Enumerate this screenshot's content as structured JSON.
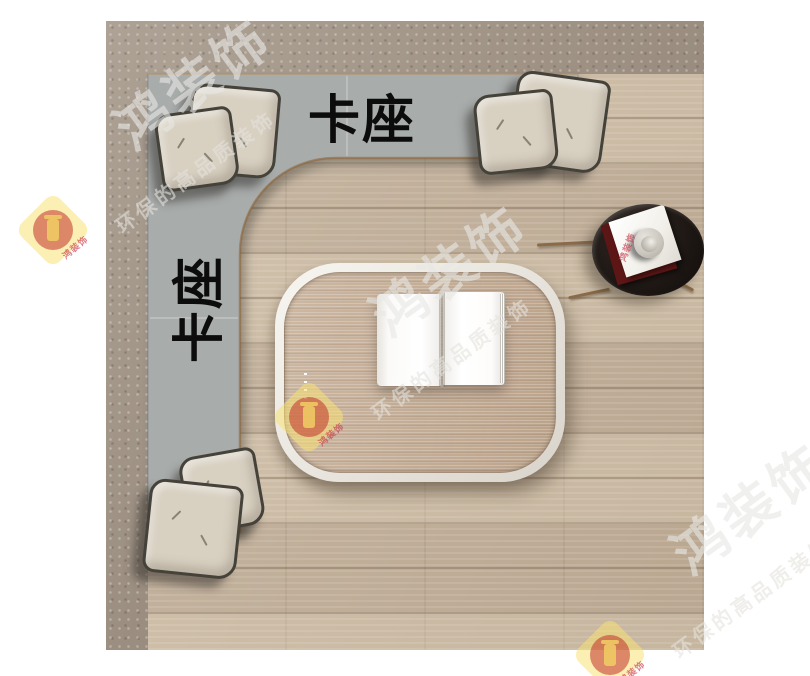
{
  "labels": {
    "bench_top": "卡座",
    "bench_left": "卡座"
  },
  "watermark": {
    "big_text": "鸿装饰",
    "tagline": "环保的高品质装饰",
    "brand_small": "鸿装饰",
    "diamond_color": "#f7e274",
    "circle_color": "#c1322a"
  },
  "colors": {
    "background": "#ffffff",
    "wall_band": "#a5988a",
    "wood_floor": "#c9b8a2",
    "bench": "#a8acab",
    "pillow": "#d8d0c1",
    "pillow_outline": "#45423a",
    "table_rim": "#f3f1ec",
    "table_top": "#c3ab93",
    "book_pages": "#ffffff",
    "side_table": "#1c1512",
    "label_text": "#0c0c0c"
  },
  "scene": {
    "pillows": [
      {
        "x": 82,
        "y": 65,
        "s": 84,
        "rot": 5
      },
      {
        "x": 52,
        "y": 89,
        "s": 72,
        "rot": -8
      },
      {
        "x": 406,
        "y": 54,
        "s": 88,
        "rot": 8
      },
      {
        "x": 370,
        "y": 71,
        "s": 74,
        "rot": -6
      },
      {
        "x": 77,
        "y": 431,
        "s": 72,
        "rot": -10
      },
      {
        "x": 40,
        "y": 461,
        "s": 88,
        "rot": 6
      }
    ],
    "watermark_units": [
      {
        "x": 53,
        "y": 230
      },
      {
        "x": 309,
        "y": 417
      },
      {
        "x": 610,
        "y": 655
      }
    ],
    "stray_brand_marks": [
      {
        "x": 627,
        "y": 247,
        "rot": -70
      }
    ]
  }
}
